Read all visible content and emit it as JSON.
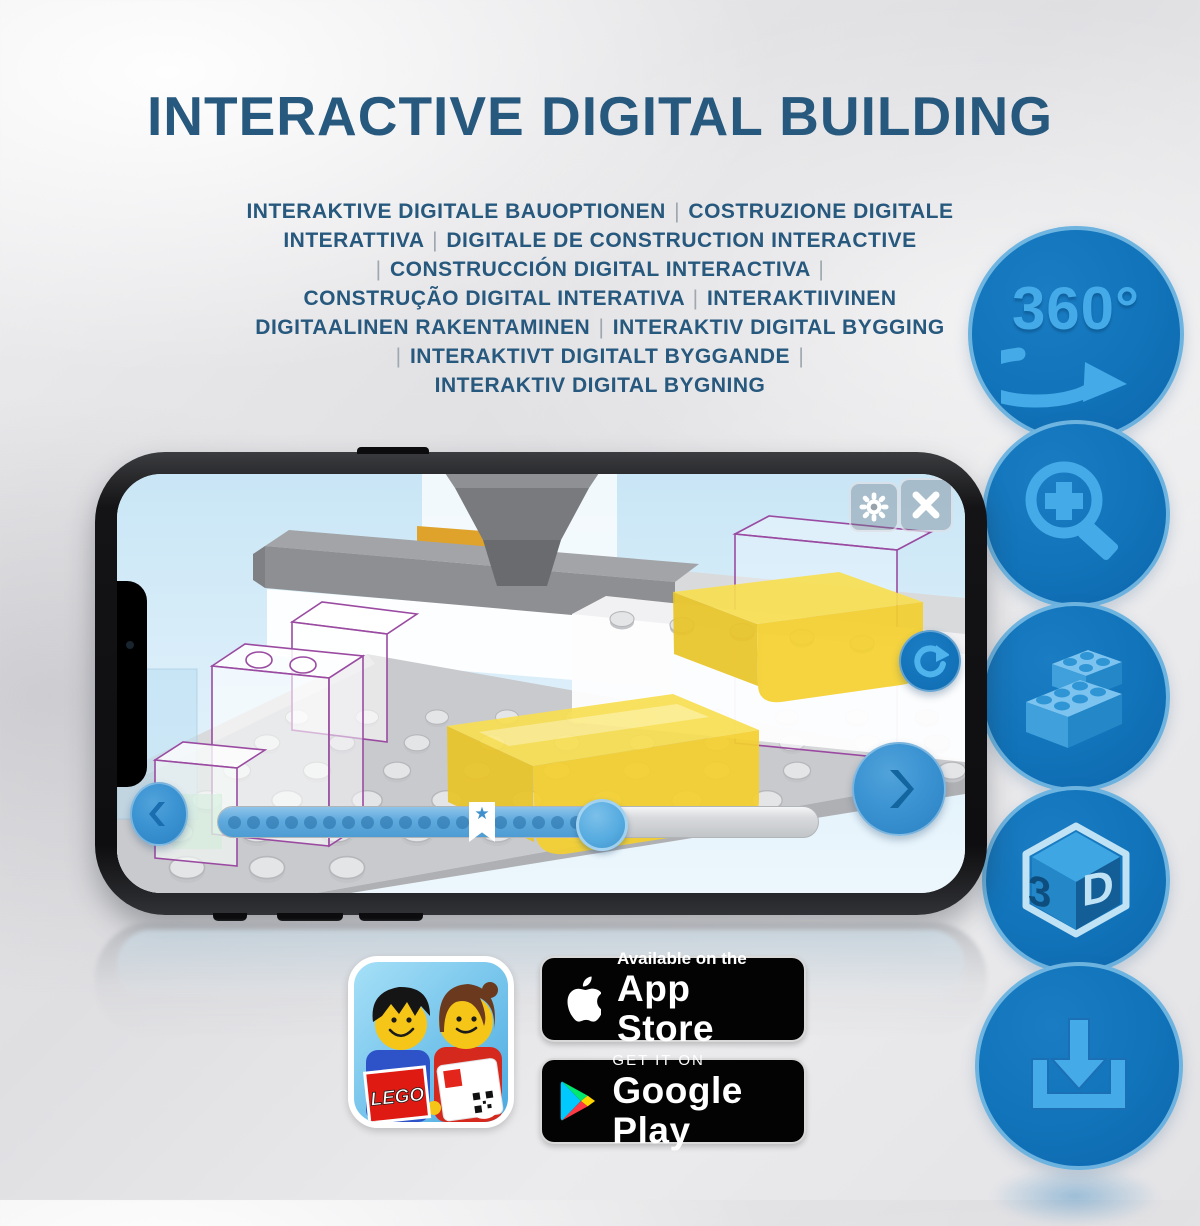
{
  "header": {
    "title": "INTERACTIVE DIGITAL BUILDING"
  },
  "subtitle": {
    "lines": [
      "INTERAKTIVE DIGITALE BAUOPTIONEN | COSTRUZIONE DIGITALE",
      "INTERATTIVA | DIGITALE DE CONSTRUCTION INTERACTIVE",
      "| CONSTRUCCIÓN DIGITAL INTERACTIVA |",
      "CONSTRUÇÃO DIGITAL INTERATIVA | INTERAKTIIVINEN",
      "DIGITAALINEN RAKENTAMINEN | INTERAKTIV DIGITAL BYGGING",
      "| INTERAKTIVT DIGITALT BYGGANDE |",
      "INTERAKTIV DIGITAL BYGNING"
    ]
  },
  "features": [
    {
      "name": "360-rotation",
      "label": "360°",
      "icon": "rotate-360-arrow-icon"
    },
    {
      "name": "zoom-in",
      "label": "",
      "icon": "magnifier-plus-icon"
    },
    {
      "name": "brick-building",
      "label": "",
      "icon": "lego-bricks-icon"
    },
    {
      "name": "3d-view",
      "label_left": "3",
      "label_right": "D",
      "icon": "3d-cube-icon"
    },
    {
      "name": "download",
      "label": "",
      "icon": "download-tray-icon"
    }
  ],
  "phone": {
    "app_ui": {
      "settings_icon": "gear-icon",
      "close_icon": "close-icon",
      "rotate_icon": "rotate-refresh-icon",
      "back_icon": "chevron-left-icon",
      "next_icon": "chevron-right-icon",
      "bookmark_icon": "star-bookmark-icon",
      "star_glyph": "★"
    },
    "slider": {
      "progress": 0.635,
      "bookmark_position": 0.44,
      "dot_count": 19
    }
  },
  "store_badges": {
    "app_store": {
      "line1": "Available on the",
      "line2": "App Store",
      "logo": "apple-icon"
    },
    "google_play": {
      "line1": "GET IT ON",
      "line2": "Google Play",
      "logo": "play-triangle-icon"
    }
  },
  "app_icon": {
    "logo_text": "LEGO"
  },
  "colors": {
    "title_blue": "#27587D",
    "circle_blue": "#1173B9",
    "glyph_blue": "#45AAE8",
    "slider_blue": "#5EA9DD",
    "lego_red": "#DF1A12",
    "brick_yellow": "#F4D02F",
    "ghost_outline_purple": "#9A4BA1"
  }
}
